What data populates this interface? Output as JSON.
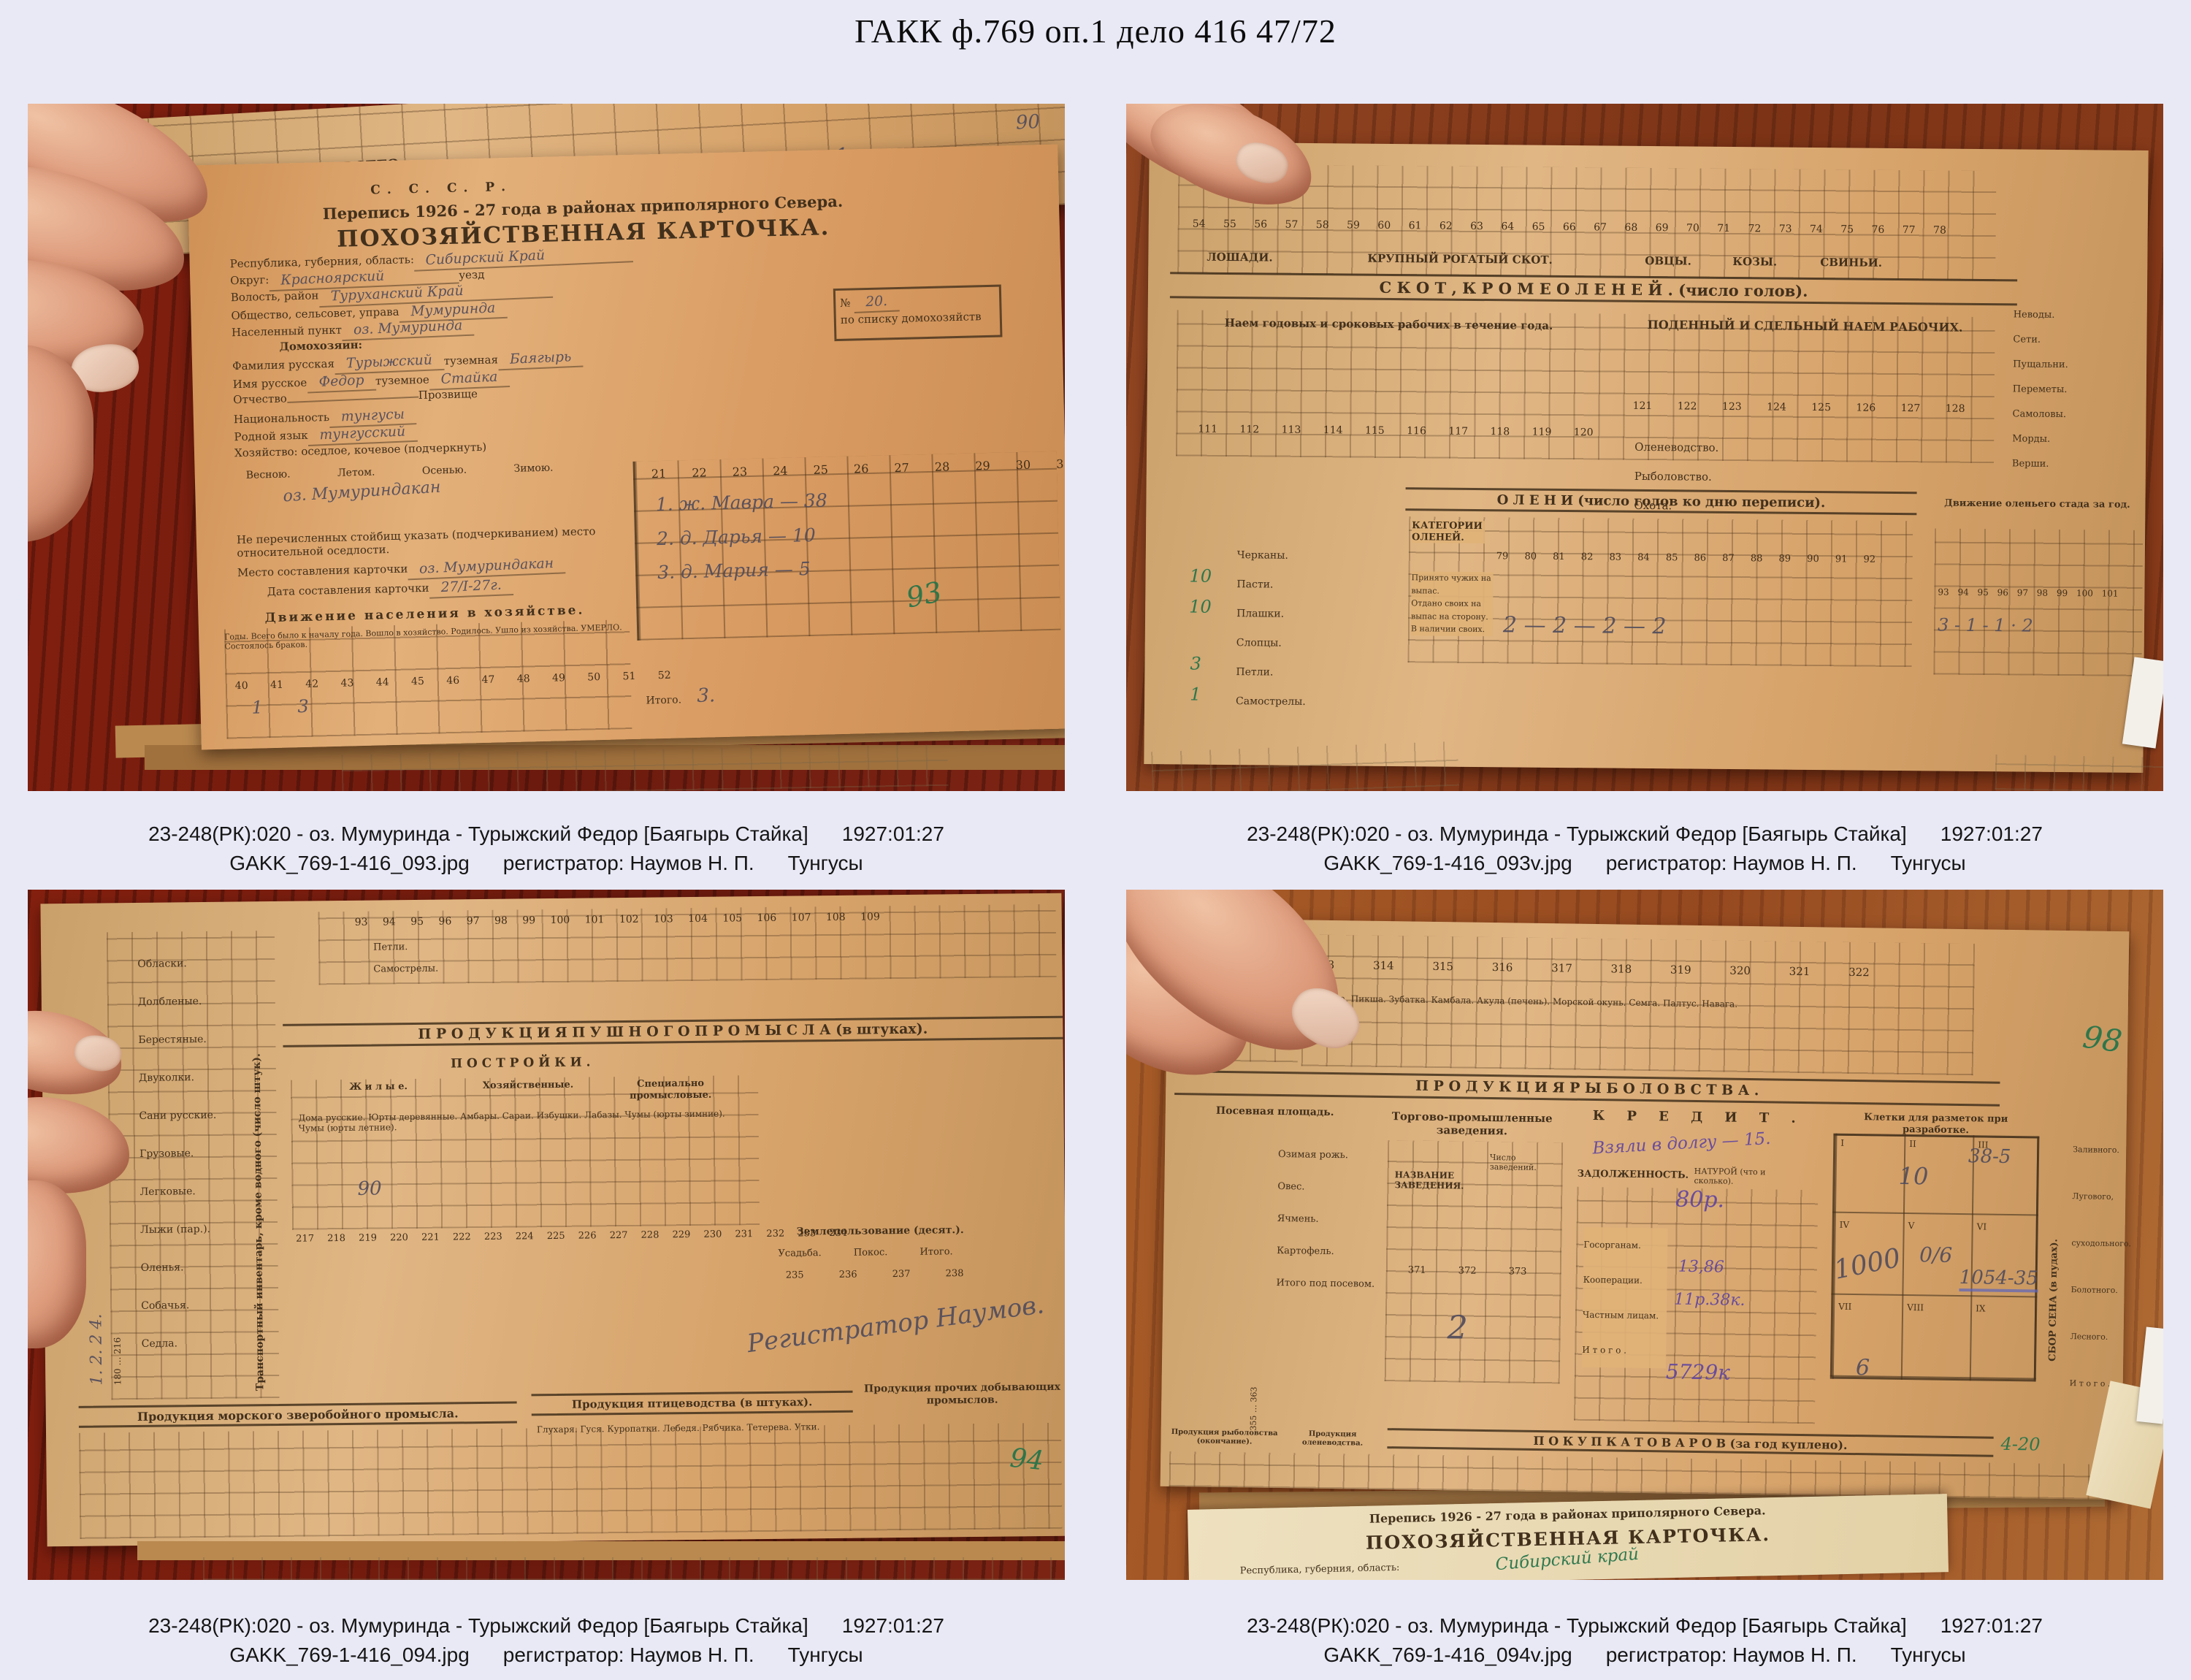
{
  "page": {
    "title": "ГАКК ф.769 оп.1 дело 416 47/72"
  },
  "colors": {
    "bg": "#e9e9f6",
    "ink": "#42301c",
    "pencil": "#55505c",
    "green": "#2d7a50",
    "violet": "#6a4a9e"
  },
  "photos": [
    {
      "id": "GAKK_769-1-416_093",
      "caption": {
        "catalog": "23-248(РК):020 - оз. Мумуринда - Турыжский Федор [Баягырь Стайка]",
        "date": "1927:01:27",
        "file": "GAKK_769-1-416_093.jpg",
        "registrar": "регистратор: Наумов Н. П.",
        "ethnos": "Тунгусы"
      },
      "doc": {
        "ussr": "С.  С.  С.  Р.",
        "census": "Перепись 1926 - 27 года в районах приполярного Севера.",
        "card_title": "ПОХОЗЯЙСТВЕННАЯ  КАРТОЧКА.",
        "strip": {
          "total": "ВСЕГО.",
          "caught": "Добыто за год.",
          "hw1": "100.",
          "hw2": "1.",
          "hw3": "90"
        },
        "list_no_label": "№",
        "list_no_hw": "20.",
        "list_no_sub": "по списку домохозяйств",
        "fields": [
          {
            "label": "Республика, губерния, область:",
            "value": "Сибирский Край"
          },
          {
            "label": "Округ:",
            "value": "Красноярский",
            "label2": "уезд"
          },
          {
            "label": "Волость, район",
            "value": "Туруханский Край"
          },
          {
            "label": "Общество, сельсовет, управа",
            "value": "Мумуринда"
          },
          {
            "label": "Населенный пункт",
            "value": "оз. Мумуринда"
          },
          {
            "label": "Домохозяин:",
            "value": ""
          },
          {
            "label": "Фамилия русская",
            "value": "Турыжский",
            "label2": "туземная",
            "value2": "Баягырь"
          },
          {
            "label": "Имя русское",
            "value": "Федор",
            "label2": "туземное",
            "value2": "Стайка"
          },
          {
            "label": "Отчество",
            "value": "",
            "label2": "Прозвище",
            "value2": ""
          },
          {
            "label": "Национальность",
            "value": "тунгусы"
          },
          {
            "label": "Родной язык",
            "value": "тунгусский"
          },
          {
            "label": "Хозяйство: оседлое, кочевое (подчеркнуть)",
            "value": ""
          }
        ],
        "seasons": [
          "Весною.",
          "Летом.",
          "Осенью.",
          "Зимою."
        ],
        "seasons_hw": "оз. Мумуриндакан",
        "note": "Не перечисленных стойбищ указать (подчеркиванием) место относительной оседлости.",
        "place_label": "Место составления карточки",
        "place_value": "оз. Мумуриндакан",
        "date_label": "Дата составления карточки",
        "date_value": "27/I-27г.",
        "member_nums": [
          "21",
          "22",
          "23",
          "24",
          "25",
          "26",
          "27",
          "28",
          "29",
          "30",
          "31"
        ],
        "members": [
          "1.   ж.   Мавра   —   38",
          "2.   д.   Дарья   —   10",
          "3.   д.   Мария   —   5"
        ],
        "move_title": "Движение населения в хозяйстве.",
        "move_heads": [
          "Годы.",
          "Всего было к началу года.",
          "Вошло в хозяйство.",
          "Родилось.",
          "Ушло из хозяйства.",
          "УМЕРЛО.",
          "Состоялось браков."
        ],
        "move_nums": [
          "40",
          "41",
          "42",
          "43",
          "44",
          "45",
          "46",
          "47",
          "48",
          "49",
          "50",
          "51",
          "52"
        ],
        "move_hw": "1    3",
        "move_total_label": "Итого.",
        "move_total": "3.",
        "sheet_no": "93"
      }
    },
    {
      "id": "GAKK_769-1-416_093v",
      "caption": {
        "catalog": "23-248(РК):020 - оз. Мумуринда - Турыжский Федор [Баягырь Стайка]",
        "date": "1927:01:27",
        "file": "GAKK_769-1-416_093v.jpg",
        "registrar": "регистратор: Наумов Н. П.",
        "ethnos": "Тунгусы"
      },
      "doc": {
        "top_nums": [
          "54",
          "55",
          "56",
          "57",
          "58",
          "59",
          "60",
          "61",
          "62",
          "63",
          "64",
          "65",
          "66",
          "67",
          "68",
          "69",
          "70",
          "71",
          "72",
          "73",
          "74",
          "75",
          "76",
          "77",
          "78"
        ],
        "livestock_groups": [
          "ЛОШАДИ.",
          "КРУПНЫЙ РОГАТЫЙ СКОТ.",
          "ОВЦЫ.",
          "КОЗЫ.",
          "СВИНЬИ."
        ],
        "band_livestock": "С К О Т ,   К Р О М Е   О Л Е Н Е Й .   (число голов).",
        "hire_year": "Наем годовых и сроковых рабочих в течение года.",
        "hire_day": "ПОДЕННЫЙ И СДЕЛЬНЫЙ НАЕМ РАБОЧИХ.",
        "hire_rows": [
          "Оленеводство.",
          "Рыболовство.",
          "Охота."
        ],
        "hire_nums1": [
          "111",
          "112",
          "113",
          "114",
          "115",
          "116",
          "117",
          "118",
          "119",
          "120"
        ],
        "hire_nums2": [
          "121",
          "122",
          "123",
          "124",
          "125",
          "126",
          "127",
          "128"
        ],
        "band_deer": "О Л Е Н И    (число голов ко дню переписи).",
        "deer_cat": "КАТЕГОРИИ ОЛЕНЕЙ.",
        "deer_rows": [
          "Принято чужих на выпас.",
          "Отдано своих на выпас на сторону.",
          "В наличии своих."
        ],
        "deer_nums": [
          "79",
          "80",
          "81",
          "82",
          "83",
          "84",
          "85",
          "86",
          "87",
          "88",
          "89",
          "90",
          "91",
          "92"
        ],
        "deer_hw": "2   —   2   —   2   —   2",
        "band_herd": "Движение оленьего стада за год.",
        "herd_nums": [
          "93",
          "94",
          "95",
          "96",
          "97",
          "98",
          "99",
          "100",
          "101"
        ],
        "herd_hw": "3  -  1  -  1  ·  2",
        "traps_rows": [
          "Черканы.",
          "Пасти.",
          "Плашки.",
          "Слопцы.",
          "Петли.",
          "Самострелы."
        ],
        "traps_hw": [
          "10",
          "10",
          "3",
          "1"
        ],
        "nets_rows": [
          "Неводы.",
          "Сети.",
          "Пущальни.",
          "Переметы.",
          "Самоловы.",
          "Морды.",
          "Верши."
        ]
      }
    },
    {
      "id": "GAKK_769-1-416_094",
      "caption": {
        "catalog": "23-248(РК):020 - оз. Мумуринда - Турыжский Федор [Баягырь Стайка]",
        "date": "1927:01:27",
        "file": "GAKK_769-1-416_094.jpg",
        "registrar": "регистратор: Наумов Н. П.",
        "ethnos": "Тунгусы"
      },
      "doc": {
        "top_nums": [
          "93",
          "94",
          "95",
          "96",
          "97",
          "98",
          "99",
          "100",
          "101",
          "102",
          "103",
          "104",
          "105",
          "106",
          "107",
          "108",
          "109"
        ],
        "top_rows": [
          "Петли.",
          "Самострелы."
        ],
        "transport_vertical": "Транспортный инвентарь, кроме водного (число штук).",
        "transport_rows": [
          "Обласки.",
          "Долбленые.",
          "Берестяные.",
          "Двуколки.",
          "Сани русские.",
          "Грузовые.",
          "Легковые.",
          "Лыжи (пар.).",
          "Оленья.",
          "Собачья.",
          "Седла."
        ],
        "transport_nums": "180 … 216",
        "hw_marks": "1.    2.    2    4.",
        "band_fur": "П Р О Д У К Ц И Я    П У Ш Н О Г О    П Р О М Ы С Л А    (в штуках).",
        "build_title": "П О С Т Р О Й К И .",
        "build_groups": [
          "Ж и л ы е.",
          "Хозяйственные.",
          "Специально промысловые."
        ],
        "build_cols": [
          "Дома русские.",
          "Юрты деревянные.",
          "Амбары.",
          "Сараи.",
          "Избушки.",
          "Лабазы.",
          "Чумы (юрты зимние).",
          "Чумы (юрты летние)."
        ],
        "build_nums": [
          "217",
          "218",
          "219",
          "220",
          "221",
          "222",
          "223",
          "224",
          "225",
          "226",
          "227",
          "228",
          "229",
          "230",
          "231",
          "232",
          "233",
          "234"
        ],
        "land_title": "Землепользование (десят.).",
        "land_cols": [
          "Усадьба.",
          "Покос.",
          "Итого."
        ],
        "land_nums": [
          "235",
          "236",
          "237",
          "238"
        ],
        "registrar_hw": "Регистратор    Наумов.",
        "band_sea": "Продукция морского зверобойного промысла.",
        "band_bird": "Продукция птицеводства (в штуках).",
        "band_other": "Продукция прочих добывающих промыслов.",
        "bird_cols": [
          "Глухаря.",
          "Гуся.",
          "Куропатки.",
          "Лебедя.",
          "Рябчика.",
          "Тетерева.",
          "Утки."
        ],
        "sheet_no": "94"
      }
    },
    {
      "id": "GAKK_769-1-416_094v",
      "caption": {
        "catalog": "23-248(РК):020 - оз. Мумуринда - Турыжский Федор [Баягырь Стайка]",
        "date": "1927:01:27",
        "file": "GAKK_769-1-416_094v.jpg",
        "registrar": "регистратор: Наумов Н. П.",
        "ethnos": "Тунгусы"
      },
      "doc": {
        "corner": {
          "caught": "Добыто за год.",
          "total": "ВСЕГО.",
          "gos": "Госорганам.",
          "coop": "Кооперации."
        },
        "fish_nums": [
          "313",
          "314",
          "315",
          "316",
          "317",
          "318",
          "319",
          "320",
          "321",
          "322"
        ],
        "fish_cols": [
          "Треска.",
          "Пикша.",
          "Зубатка.",
          "Камбала.",
          "Акула (печень).",
          "Морской окунь.",
          "Семга.",
          "Палтус.",
          "Навага."
        ],
        "band_fish": "П Р О Д У К Ц И Я    Р Ы Б О Л О В С Т В А .",
        "sow_title": "Посевная площадь.",
        "crop_rows": [
          "Озимая рожь.",
          "Овес.",
          "Ячмень.",
          "Картофель.",
          "Итого под посевом."
        ],
        "crop_nums": "355 … 363",
        "trade_title": "Торгово-промышленные заведения.",
        "trade_name": "НАЗВАНИЕ ЗАВЕДЕНИЯ.",
        "trade_count": "Число заведений.",
        "trade_nums": [
          "371",
          "372",
          "373"
        ],
        "credit_title": "К Р Е Д И Т .",
        "credit_hw": "Взяли в долгу — 15.",
        "debt_label": "ЗАДОЛЖЕННОСТЬ.",
        "natura_label": "НАТУРОЙ (что и сколько).",
        "debt_rows": [
          "Госорганам.",
          "Кооперации.",
          "Частным лицам.",
          "И т о г о ."
        ],
        "debt_hw": [
          "80р.",
          "13,86",
          "11р.38к.",
          "5729к"
        ],
        "cells_title": "Клетки для разметок при разработке.",
        "cells_roman": [
          "I",
          "II",
          "III",
          "IV",
          "V",
          "VI",
          "VII",
          "VIII",
          "IX"
        ],
        "cells_hw": [
          "10",
          "38-5",
          "1000",
          "0/6",
          "1054-35",
          "6"
        ],
        "hay_vertical": "СБОР СЕНА (в пудах).",
        "hay_rows": [
          "Заливного.",
          "Лугового, суходольного.",
          "Болотного.",
          "Лесного.",
          "И т о г о ."
        ],
        "band_fish_end": "Продукция рыболовства (окончание).",
        "band_deerprod": "Продукция оленеводства.",
        "band_buy": "П О К У П К А    Т О В А Р О В    (за год куплено).",
        "buy_hw": "4-20",
        "sheet_no": "98",
        "next_card": {
          "census": "Перепись 1926 - 27 года в районах приполярного Севера.",
          "title": "ПОХОЗЯЙСТВЕННАЯ  КАРТОЧКА.",
          "region_label": "Республика, губерния, область:",
          "region_hw": "Сибирский край"
        }
      }
    }
  ]
}
